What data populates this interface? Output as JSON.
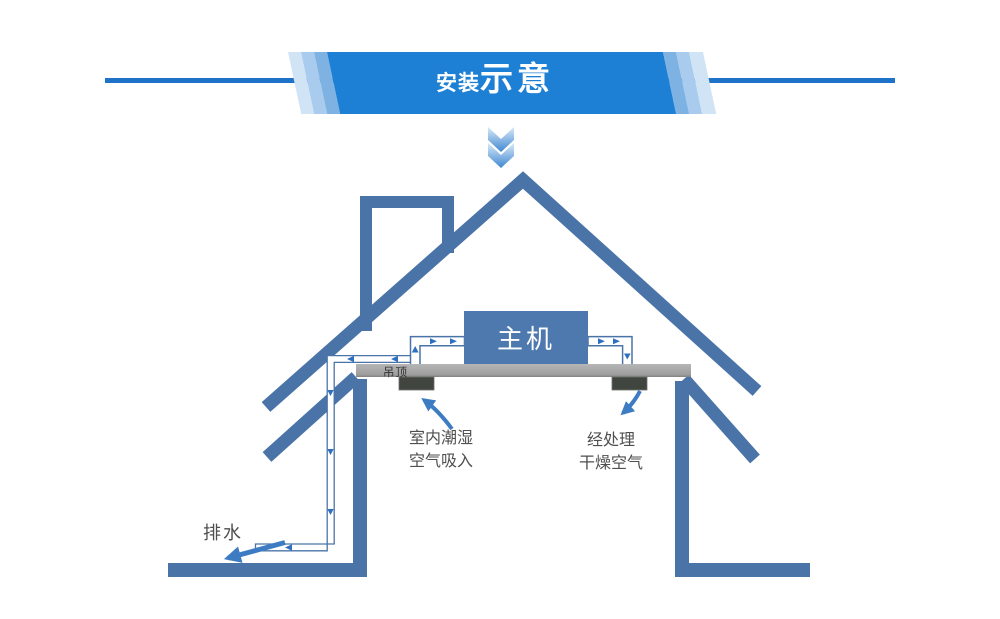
{
  "banner": {
    "title_prefix": "安装",
    "title_main": "示意"
  },
  "house": {
    "unit_label": "主机",
    "ceiling_label": "吊顶",
    "intake_label": [
      "室内潮湿",
      "空气吸入"
    ],
    "outlet_label": [
      "经处理",
      "干燥空气"
    ],
    "drain_label": "排水"
  },
  "colors": {
    "banner_blue": "#1e80d4",
    "banner_stripe_light": "#d0e4f6",
    "banner_stripe_mid": "#a8cbee",
    "banner_stripe_dark": "#7db2e2",
    "rule_blue": "#1e73c8",
    "house_outline_blue": "#4a74a8",
    "unit_blue": "#4e79ae",
    "ceiling_gray": "#a9a9a9",
    "vent_dark": "#40453f",
    "flow_arrow_blue": "#2e6fc0",
    "annotation_arrow_blue": "#3d7cc2",
    "label_gray": "#4f4f4f"
  }
}
